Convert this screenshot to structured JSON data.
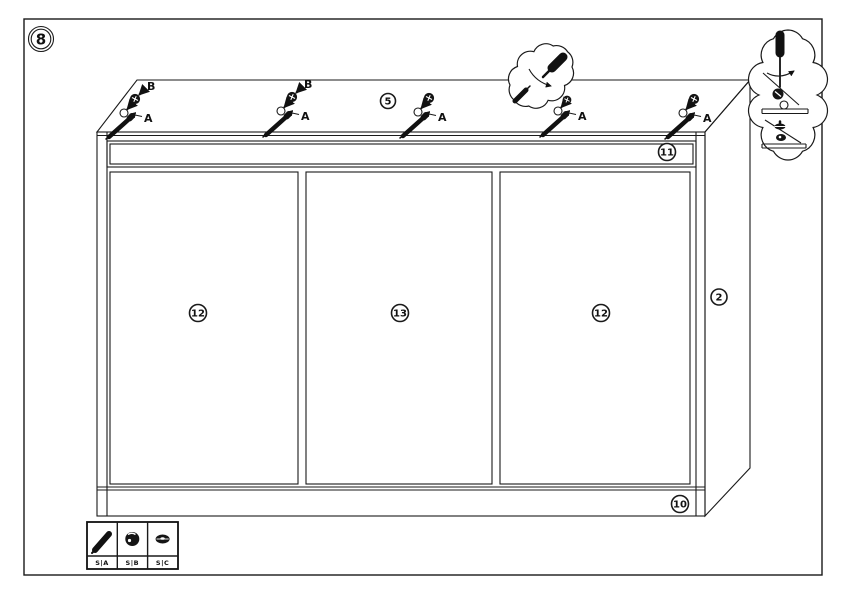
{
  "page": {
    "background": "#ffffff",
    "line_color": "#1a1a1a"
  },
  "step_badge": {
    "number": "8"
  },
  "panel_callouts": {
    "top_screw_pack": "5",
    "top_rail": "11",
    "left_door": "12",
    "center_door": "13",
    "right_door": "12",
    "side_panel": "2",
    "bottom_rail": "10"
  },
  "fastener_groups": [
    {
      "hole_label": "A",
      "bolt_label": "B"
    },
    {
      "hole_label": "A",
      "bolt_label": "B"
    },
    {
      "hole_label": "A"
    },
    {
      "hole_label": "A"
    },
    {
      "hole_label": "A"
    }
  ],
  "legend": {
    "items": [
      {
        "icon": "screw-icon",
        "code": "S|A"
      },
      {
        "icon": "cam-lock-icon",
        "code": "S|B"
      },
      {
        "icon": "cam-disc-icon",
        "code": "S|C"
      }
    ]
  }
}
